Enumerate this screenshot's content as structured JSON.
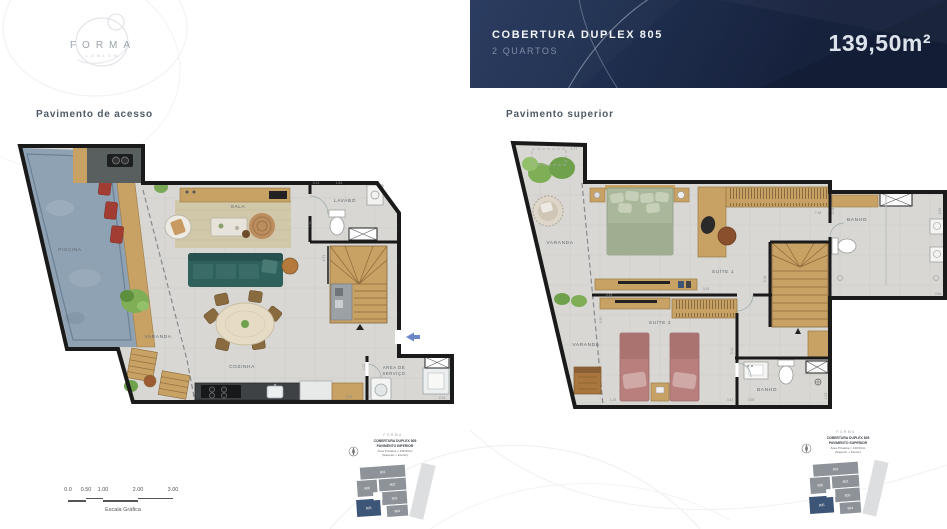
{
  "logo": {
    "name": "FORMA",
    "sub": "LEBLON"
  },
  "header": {
    "title": "COBERTURA DUPLEX 805",
    "subtitle": "2 QUARTOS",
    "area": "139,50m²"
  },
  "left_plan": {
    "label": "Pavimento de acesso",
    "rooms": {
      "piscina": "PISCINA",
      "varanda": "VARANDA",
      "sala": "SALA",
      "lavabo": "LAVABO",
      "cozinha": "COZINHA",
      "servico_1": "AREA DE",
      "servico_2": "SERVIÇO"
    },
    "dims": {
      "top_1": "5.13",
      "top_2": "1.84",
      "lavabo_h": "1.50",
      "stair_h": "4.73",
      "servico_h": "1.22",
      "servico_w": "2.24",
      "counter_w": "3.04"
    }
  },
  "right_plan": {
    "label": "Pavimento superior",
    "rooms": {
      "varanda_top": "VARANDA",
      "varanda_bottom": "VARANDA",
      "suite1": "SUÍTE 1",
      "suite2": "SUÍTE 2",
      "banho_top": "BANHO",
      "banho_bottom": "BANHO"
    },
    "dims": {
      "top": "1.77",
      "wardrobe": "7.18",
      "banho_t_left": "2.04",
      "banho_t_right": "2.62",
      "banho_t_bottom": "2.64",
      "stair": "3.18",
      "tv1": "3.19",
      "tv2": "4.15",
      "varanda_v": "3.20",
      "varanda_b": "1.19",
      "banho_b_1": "3.42",
      "banho_b_2": "2.59",
      "banho_b_r": "1.23",
      "hall_v": "3.12"
    }
  },
  "scalebar": {
    "ticks": [
      "0.0",
      "0.50",
      "1.00",
      "2.00",
      "3.00"
    ],
    "label": "Escala Gráfica"
  },
  "keyplans": [
    {
      "brand": "FORMA",
      "line1": "COBERTURA DUPLEX 805",
      "line2": "PAVIMENTO INFERIOR",
      "line3": "Área Privativa = 139,50m²",
      "line4": "(Superior + Inferior)",
      "units": {
        "u801": "801",
        "u802": "802",
        "u803": "803",
        "u804": "804",
        "u805": "805",
        "u806": "806"
      }
    },
    {
      "brand": "FORMA",
      "line1": "COBERTURA DUPLEX 805",
      "line2": "PAVIMENTO SUPERIOR",
      "line3": "Área Privativa = 139,50m²",
      "line4": "(Superior + Inferior)",
      "units": {
        "u801": "801",
        "u802": "802",
        "u803": "803",
        "u804": "804",
        "u805": "805",
        "u806": "806"
      }
    }
  ],
  "colors": {
    "header_bg": "#273a5e",
    "header_bg2": "#16213c",
    "unit_highlight": "#3d5577",
    "pool": "#8ea2b4",
    "wood": "#c8a165",
    "sofa": "#2e605c",
    "bed1": "#a9b79a",
    "bed2": "#b97f7c",
    "entry": "#6b87c8"
  }
}
